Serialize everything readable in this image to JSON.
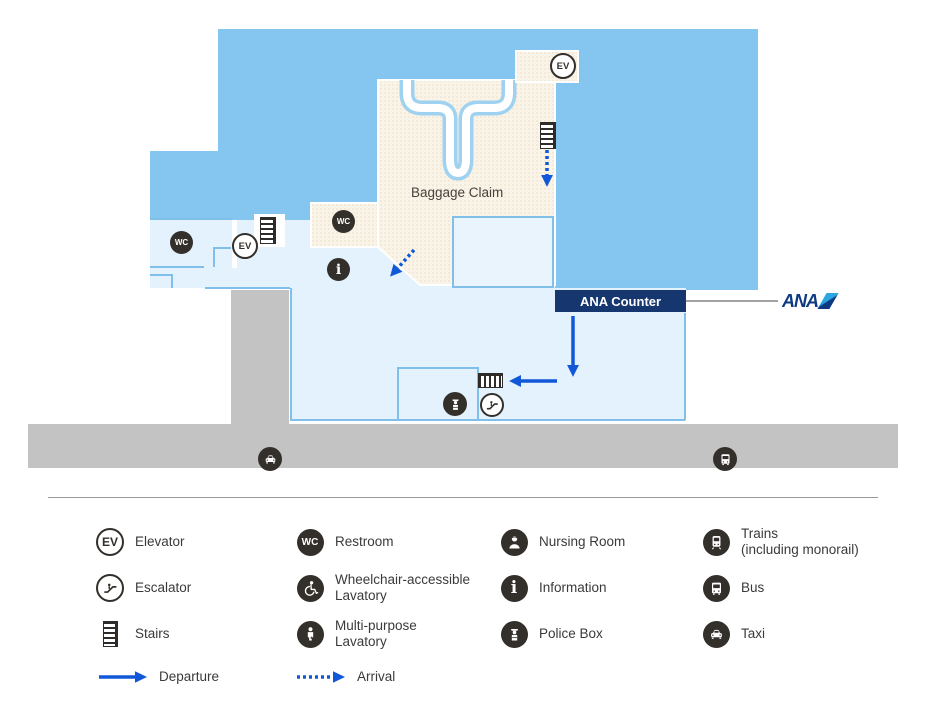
{
  "map": {
    "baggage_claim_label": "Baggage Claim",
    "ana_counter_label": "ANA Counter",
    "ana_logo_text": "ANA",
    "icon_labels": {
      "elevator": "EV",
      "restroom": "WC",
      "information": "i"
    },
    "map_icons": [
      "restroom",
      "elevator",
      "stairs",
      "restroom",
      "information",
      "elevator",
      "stairs",
      "stairs",
      "police-box",
      "escalator",
      "taxi",
      "bus"
    ],
    "arrows": {
      "departure": [
        "from ANA Counter down",
        "left toward stairs near escalator"
      ],
      "arrival": [
        "down from stairs in Baggage Claim",
        "diagonal down-left from Baggage Claim exit"
      ]
    }
  },
  "legend": {
    "items": [
      {
        "icon": "elevator-icon",
        "label": "Elevator"
      },
      {
        "icon": "restroom-icon",
        "label": "Restroom"
      },
      {
        "icon": "nursing-room-icon",
        "label": "Nursing Room"
      },
      {
        "icon": "trains-icon",
        "label": "Trains",
        "label2": "(including monorail)"
      },
      {
        "icon": "escalator-icon",
        "label": "Escalator"
      },
      {
        "icon": "wheelchair-icon",
        "label": "Wheelchair-accessible",
        "label2": "Lavatory"
      },
      {
        "icon": "information-icon",
        "label": "Information"
      },
      {
        "icon": "bus-icon",
        "label": "Bus"
      },
      {
        "icon": "stairs-icon",
        "label": "Stairs"
      },
      {
        "icon": "multipurpose-icon",
        "label": "Multi-purpose",
        "label2": "Lavatory"
      },
      {
        "icon": "police-box-icon",
        "label": "Police Box"
      },
      {
        "icon": "taxi-icon",
        "label": "Taxi"
      },
      {
        "icon": "departure-arrow",
        "label": "Departure"
      },
      {
        "icon": "arrival-arrow",
        "label": "Arrival"
      }
    ]
  },
  "colors": {
    "terminal_blue": "#85c6f0",
    "concourse_light_blue": "#e3f2fc",
    "baggage_claim_beige": "#faf3e8",
    "road_gray": "#c3c3c3",
    "counter_navy": "#16366f",
    "arrow_blue": "#1158d8",
    "icon_dark": "#332f2b",
    "ana_navy": "#0d3a80",
    "ana_cyan": "#2ca6e0",
    "wall_blue": "#7fbfea"
  }
}
